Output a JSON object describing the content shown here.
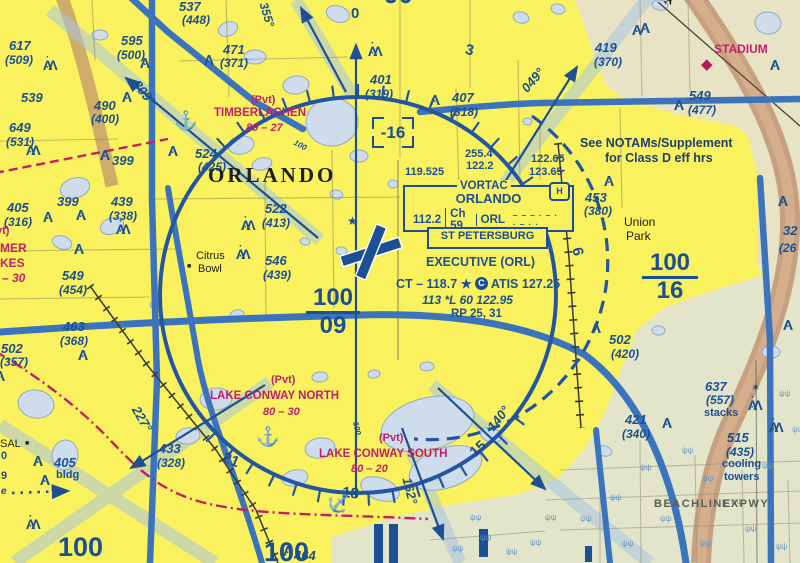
{
  "chart": {
    "kind": "VFR terminal area chart excerpt",
    "city": "ORLANDO"
  },
  "colors": {
    "urban_yellow": "#f9f25e",
    "rural_tan": "#e7e3c4",
    "rural_green": "#e2e5c9",
    "navy": "#1c4f93",
    "ring_blue": "#2456a0",
    "road_blue": "#3b74bd",
    "corridor_blue": "#a8c6e4",
    "magenta": "#c21e6c",
    "water": "#cfdcec",
    "brown_band": "#bf8e6e"
  },
  "navaid": {
    "type": "VORTAC",
    "name": "ORLANDO",
    "freq": "112.2",
    "channel": "Ch 59",
    "ident": "ORL",
    "morse": "‒ ‒ ‒  · ‒ ·  · ‒ · ·",
    "h_symbol": "H",
    "related_box": "ST PETERSBURG"
  },
  "airport": {
    "name": "EXECUTIVE (ORL)",
    "ct": "CT – 118.7 ★",
    "class_letter": "C",
    "atis": "ATIS 127.25",
    "data_line": "113 *L 60 122.95",
    "rp": "RP 25, 31"
  },
  "mef": {
    "value": "-16"
  },
  "class_b_sectors": [
    {
      "top": "100",
      "bottom": "09"
    },
    {
      "top": "100",
      "bottom": "16"
    }
  ],
  "labels": [
    {
      "k": "ob",
      "t": "537",
      "x": 179,
      "y": 0
    },
    {
      "k": "obp",
      "t": "(448)",
      "x": 182,
      "y": 14
    },
    {
      "k": "ob",
      "t": "617",
      "x": 9,
      "y": 39
    },
    {
      "k": "obp",
      "t": "(509)",
      "x": 5,
      "y": 54
    },
    {
      "k": "ob",
      "t": "595",
      "x": 121,
      "y": 34
    },
    {
      "k": "obp",
      "t": "(500)",
      "x": 117,
      "y": 49
    },
    {
      "k": "ob",
      "t": "471",
      "x": 223,
      "y": 43
    },
    {
      "k": "obp",
      "t": "(371)",
      "x": 220,
      "y": 57
    },
    {
      "k": "ob",
      "t": "539",
      "x": 21,
      "y": 91
    },
    {
      "k": "ob",
      "t": "490",
      "x": 94,
      "y": 99
    },
    {
      "k": "obp",
      "t": "(400)",
      "x": 91,
      "y": 113
    },
    {
      "k": "ob",
      "t": "649",
      "x": 9,
      "y": 121
    },
    {
      "k": "obp",
      "t": "(531)",
      "x": 6,
      "y": 136
    },
    {
      "k": "ob",
      "t": "399",
      "x": 112,
      "y": 154
    },
    {
      "k": "ob",
      "t": "524",
      "x": 195,
      "y": 147
    },
    {
      "k": "obp",
      "t": "(425)",
      "x": 198,
      "y": 161
    },
    {
      "k": "ob",
      "t": "399",
      "x": 57,
      "y": 195
    },
    {
      "k": "ob",
      "t": "439",
      "x": 111,
      "y": 195
    },
    {
      "k": "obp",
      "t": "(338)",
      "x": 109,
      "y": 210
    },
    {
      "k": "ob",
      "t": "405",
      "x": 7,
      "y": 201
    },
    {
      "k": "obp",
      "t": "(316)",
      "x": 4,
      "y": 216
    },
    {
      "k": "ob",
      "t": "549",
      "x": 62,
      "y": 269
    },
    {
      "k": "obp",
      "t": "(454)",
      "x": 59,
      "y": 284
    },
    {
      "k": "ob",
      "t": "463",
      "x": 63,
      "y": 320
    },
    {
      "k": "obp",
      "t": "(368)",
      "x": 60,
      "y": 335
    },
    {
      "k": "ob",
      "t": "502",
      "x": 1,
      "y": 342
    },
    {
      "k": "obp",
      "t": "(357)",
      "x": 0,
      "y": 356
    },
    {
      "k": "ob",
      "t": "522",
      "x": 265,
      "y": 202
    },
    {
      "k": "obp",
      "t": "(413)",
      "x": 262,
      "y": 217
    },
    {
      "k": "ob",
      "t": "546",
      "x": 265,
      "y": 254
    },
    {
      "k": "obp",
      "t": "(439)",
      "x": 263,
      "y": 269
    },
    {
      "k": "ob",
      "t": "401",
      "x": 370,
      "y": 73
    },
    {
      "k": "obp",
      "t": "(319)",
      "x": 365,
      "y": 88
    },
    {
      "k": "ob",
      "t": "407",
      "x": 452,
      "y": 91
    },
    {
      "k": "obp",
      "t": "(318)",
      "x": 450,
      "y": 106
    },
    {
      "k": "ob",
      "t": "419",
      "x": 595,
      "y": 41
    },
    {
      "k": "obp",
      "t": "(370)",
      "x": 594,
      "y": 56
    },
    {
      "k": "ob",
      "t": "549",
      "x": 689,
      "y": 89
    },
    {
      "k": "obp",
      "t": "(477)",
      "x": 688,
      "y": 104
    },
    {
      "k": "ob",
      "t": "453",
      "x": 585,
      "y": 191
    },
    {
      "k": "obp",
      "t": "(380)",
      "x": 584,
      "y": 205
    },
    {
      "k": "ob",
      "t": "502",
      "x": 609,
      "y": 333
    },
    {
      "k": "obp",
      "t": "(420)",
      "x": 611,
      "y": 348
    },
    {
      "k": "ob",
      "t": "637",
      "x": 705,
      "y": 380
    },
    {
      "k": "obp",
      "t": "(557)",
      "x": 706,
      "y": 394
    },
    {
      "k": "ob",
      "t": "421",
      "x": 625,
      "y": 413
    },
    {
      "k": "obp",
      "t": "(340)",
      "x": 622,
      "y": 428
    },
    {
      "k": "ob",
      "t": "515",
      "x": 727,
      "y": 431
    },
    {
      "k": "obp",
      "t": "(435)",
      "x": 726,
      "y": 446
    },
    {
      "k": "ob",
      "t": "433",
      "x": 159,
      "y": 442
    },
    {
      "k": "obp",
      "t": "(328)",
      "x": 157,
      "y": 457
    },
    {
      "k": "ob",
      "t": "405",
      "x": 54,
      "y": 456
    },
    {
      "k": "nvy",
      "t": "bldg",
      "x": 56,
      "y": 470
    },
    {
      "k": "ob",
      "t": "464",
      "x": 294,
      "y": 549
    },
    {
      "k": "ob",
      "t": "32",
      "x": 783,
      "y": 224
    },
    {
      "k": "obp",
      "t": "(26",
      "x": 779,
      "y": 242
    },
    {
      "k": "nvy",
      "t": "0",
      "x": 1,
      "y": 451
    },
    {
      "k": "nvy",
      "t": "9",
      "x": 1,
      "y": 471
    },
    {
      "k": "tin",
      "t": "e",
      "x": 1,
      "y": 487,
      "s": 10
    },
    {
      "k": "mag",
      "t": "(Pvt)",
      "x": 251,
      "y": 95
    },
    {
      "k": "mag",
      "t": "TIMBERLACHEN",
      "x": 214,
      "y": 108,
      "s": 11.5,
      "n": "timberlachen-seaplane-base"
    },
    {
      "k": "magi",
      "t": "89 – 27",
      "x": 246,
      "y": 123
    },
    {
      "k": "mag",
      "t": "(Pvt)",
      "x": 271,
      "y": 375
    },
    {
      "k": "mag",
      "t": "LAKE CONWAY NORTH",
      "x": 210,
      "y": 391,
      "s": 11.5,
      "n": "lake-conway-north-seaplane-base"
    },
    {
      "k": "magi",
      "t": "80 – 30",
      "x": 263,
      "y": 407
    },
    {
      "k": "mag",
      "t": "(Pvt)",
      "x": 379,
      "y": 433
    },
    {
      "k": "mag",
      "t": "LAKE CONWAY SOUTH",
      "x": 319,
      "y": 449,
      "s": 11.5,
      "n": "lake-conway-south-seaplane-base"
    },
    {
      "k": "magi",
      "t": "80 – 20",
      "x": 351,
      "y": 464
    },
    {
      "k": "mag",
      "t": "STADIUM",
      "x": 714,
      "y": 43,
      "s": 12,
      "n": "stadium-label"
    },
    {
      "k": "mag",
      "t": "(Pvt)",
      "x": -15,
      "y": 226
    },
    {
      "k": "mag",
      "t": "MER",
      "x": 0,
      "y": 242,
      "s": 12
    },
    {
      "k": "mag",
      "t": "KES",
      "x": 0,
      "y": 257,
      "s": 12
    },
    {
      "k": "magi",
      "t": "– 30",
      "x": 2,
      "y": 272,
      "s": 12
    },
    {
      "k": "ser",
      "t": "ORLANDO",
      "x": 208,
      "y": 165,
      "n": "orlando-city-label"
    },
    {
      "k": "blk",
      "t": "Citrus",
      "x": 196,
      "y": 251
    },
    {
      "k": "blk",
      "t": "Bowl",
      "x": 198,
      "y": 264
    },
    {
      "k": "blk",
      "t": "Union",
      "x": 624,
      "y": 216,
      "s": 12
    },
    {
      "k": "blk",
      "t": "Park",
      "x": 626,
      "y": 230,
      "s": 12
    },
    {
      "k": "blk",
      "t": "SAL",
      "x": 0,
      "y": 439,
      "n": "cut-place-label"
    },
    {
      "k": "dkn",
      "t": "See NOTAMs/Supplement",
      "x": 580,
      "y": 137,
      "n": "notam-note-line1"
    },
    {
      "k": "dkn",
      "t": "for Class D eff hrs",
      "x": 605,
      "y": 152,
      "n": "notam-note-line2"
    },
    {
      "k": "gry",
      "t": "BEACHLINE",
      "x": 654,
      "y": 499
    },
    {
      "k": "gry",
      "t": "EXPWY",
      "x": 722,
      "y": 499
    },
    {
      "k": "nvy",
      "t": "stacks",
      "x": 704,
      "y": 408
    },
    {
      "k": "nvy",
      "t": "cooling",
      "x": 722,
      "y": 459
    },
    {
      "k": "nvy",
      "t": "towers",
      "x": 724,
      "y": 472
    },
    {
      "k": "cmp",
      "t": "0",
      "x": 351,
      "y": 6
    },
    {
      "k": "cmp",
      "t": "3",
      "x": 467,
      "y": 42,
      "r": 12
    },
    {
      "k": "cmp",
      "t": "6",
      "x": 584,
      "y": 246,
      "r": 78
    },
    {
      "k": "cmp",
      "t": "21",
      "x": 226,
      "y": 450,
      "r": 22
    },
    {
      "k": "cmp",
      "t": "18",
      "x": 343,
      "y": 485,
      "r": 6
    },
    {
      "k": "cmp",
      "t": "15",
      "x": 467,
      "y": 449,
      "r": -42
    },
    {
      "k": "rad",
      "t": "355°",
      "x": 269,
      "y": 1,
      "r": 73,
      "s": 12
    },
    {
      "k": "rad",
      "t": "309°",
      "x": 141,
      "y": 78,
      "r": 52
    },
    {
      "k": "rad",
      "t": "049°",
      "x": 519,
      "y": 86,
      "r": -49
    },
    {
      "k": "rad",
      "t": "227°",
      "x": 141,
      "y": 404,
      "r": 60
    },
    {
      "k": "rad",
      "t": "140°",
      "x": 485,
      "y": 425,
      "r": -52
    },
    {
      "k": "rad",
      "t": "162°",
      "x": 413,
      "y": 476,
      "r": 76
    },
    {
      "k": "frq",
      "t": "119.525",
      "x": 405,
      "y": 167
    },
    {
      "k": "frq",
      "t": "255.4",
      "x": 465,
      "y": 149
    },
    {
      "k": "frq",
      "t": "122.2",
      "x": 466,
      "y": 161
    },
    {
      "k": "frq",
      "t": "122.65",
      "x": 531,
      "y": 154
    },
    {
      "k": "frq",
      "t": "123.65",
      "x": 529,
      "y": 167
    },
    {
      "k": "tin",
      "t": "100",
      "x": 296,
      "y": 139,
      "r": 28
    },
    {
      "k": "tin",
      "t": "100",
      "x": 359,
      "y": 421,
      "r": 78
    },
    {
      "k": "big",
      "t": "100",
      "x": 58,
      "y": 534
    },
    {
      "k": "big",
      "t": "100",
      "x": 264,
      "y": 539
    },
    {
      "k": "big",
      "t": "90°",
      "x": 384,
      "y": -19,
      "s": 26
    }
  ],
  "symbols": [
    {
      "t": "✈",
      "x": 660,
      "y": -2,
      "s": 15,
      "c": "#1f1f1f",
      "r": -35,
      "n": "airplane-icon"
    },
    {
      "t": "◆",
      "x": 701,
      "y": 57,
      "s": 15,
      "c": "#b01c5e",
      "n": "stadium-diamond-icon"
    },
    {
      "t": "★",
      "x": 347,
      "y": 215,
      "s": 12,
      "c": "#1c4f93",
      "n": "beacon-star-icon"
    },
    {
      "t": "✶",
      "x": 751,
      "y": 383,
      "s": 11,
      "c": "#1c4f93",
      "n": "lighted-stacks-icon"
    },
    {
      "t": "■",
      "x": 187,
      "y": 263,
      "s": 7,
      "c": "#1f1f1f",
      "n": "citrus-bowl-square-icon"
    },
    {
      "t": "■",
      "x": 25,
      "y": 440,
      "s": 7,
      "c": "#1f1f1f",
      "n": "building-square-icon"
    },
    {
      "t": "↓",
      "x": 352,
      "y": 455,
      "s": 13,
      "c": "#c21e6c",
      "n": "seaplane-pointer-icon"
    }
  ],
  "obstacles_single": [
    [
      140,
      56
    ],
    [
      204,
      53
    ],
    [
      122,
      90
    ],
    [
      100,
      148
    ],
    [
      168,
      144
    ],
    [
      43,
      210
    ],
    [
      76,
      208
    ],
    [
      74,
      242
    ],
    [
      78,
      348
    ],
    [
      -5,
      369
    ],
    [
      430,
      93
    ],
    [
      632,
      23
    ],
    [
      674,
      98
    ],
    [
      604,
      174
    ],
    [
      591,
      321
    ],
    [
      662,
      416
    ],
    [
      640,
      21
    ],
    [
      770,
      58
    ],
    [
      778,
      194
    ],
    [
      783,
      318
    ],
    [
      283,
      544
    ],
    [
      33,
      454
    ],
    [
      40,
      473
    ]
  ],
  "obstacles_group": [
    [
      43,
      58
    ],
    [
      26,
      143
    ],
    [
      116,
      222
    ],
    [
      241,
      218
    ],
    [
      236,
      247
    ],
    [
      368,
      44
    ],
    [
      748,
      398
    ],
    [
      769,
      420
    ],
    [
      26,
      517
    ]
  ],
  "seaplane_anchors": [
    [
      174,
      112,
      0
    ],
    [
      256,
      428,
      0
    ],
    [
      327,
      494,
      42
    ]
  ],
  "lakes": [
    [
      218,
      22,
      20,
      14
    ],
    [
      326,
      6,
      24,
      16
    ],
    [
      513,
      12,
      16,
      11
    ],
    [
      551,
      4,
      14,
      10
    ],
    [
      652,
      0,
      16,
      10
    ],
    [
      755,
      12,
      26,
      22
    ],
    [
      92,
      30,
      16,
      10
    ],
    [
      244,
      50,
      22,
      14
    ],
    [
      306,
      98,
      52,
      48
    ],
    [
      283,
      76,
      26,
      18
    ],
    [
      228,
      136,
      26,
      18
    ],
    [
      252,
      158,
      20,
      12
    ],
    [
      60,
      178,
      30,
      20
    ],
    [
      100,
      218,
      24,
      16
    ],
    [
      52,
      236,
      20,
      13
    ],
    [
      330,
      190,
      13,
      9
    ],
    [
      300,
      238,
      10,
      7
    ],
    [
      336,
      247,
      11,
      8
    ],
    [
      523,
      118,
      9,
      7
    ],
    [
      350,
      150,
      18,
      12
    ],
    [
      388,
      180,
      10,
      8
    ],
    [
      200,
      388,
      32,
      22
    ],
    [
      176,
      428,
      24,
      16
    ],
    [
      305,
      438,
      30,
      20
    ],
    [
      282,
      470,
      26,
      16
    ],
    [
      380,
      398,
      95,
      52
    ],
    [
      408,
      448,
      75,
      40
    ],
    [
      360,
      478,
      40,
      22
    ],
    [
      480,
      428,
      22,
      14
    ],
    [
      596,
      446,
      16,
      10
    ],
    [
      18,
      390,
      36,
      28
    ],
    [
      52,
      440,
      26,
      30
    ],
    [
      652,
      326,
      13,
      9
    ],
    [
      762,
      346,
      18,
      12
    ],
    [
      420,
      362,
      14,
      9
    ],
    [
      312,
      372,
      16,
      10
    ],
    [
      368,
      370,
      12,
      8
    ],
    [
      230,
      310,
      14,
      9
    ],
    [
      150,
      300,
      12,
      8
    ]
  ],
  "runway_bars": [
    [
      374,
      524,
      9,
      39
    ],
    [
      389,
      524,
      9,
      39
    ],
    [
      479,
      529,
      9,
      28
    ],
    [
      585,
      546,
      7,
      16
    ]
  ],
  "marsh": [
    [
      640,
      470
    ],
    [
      682,
      453
    ],
    [
      702,
      481
    ],
    [
      731,
      504
    ],
    [
      762,
      468
    ],
    [
      660,
      521
    ],
    [
      700,
      546
    ],
    [
      745,
      531
    ],
    [
      776,
      549
    ],
    [
      610,
      500
    ],
    [
      580,
      521
    ],
    [
      622,
      546
    ],
    [
      480,
      540
    ],
    [
      452,
      551
    ],
    [
      545,
      520
    ],
    [
      506,
      554
    ],
    [
      779,
      396
    ],
    [
      792,
      432
    ],
    [
      470,
      520
    ],
    [
      530,
      545
    ]
  ]
}
